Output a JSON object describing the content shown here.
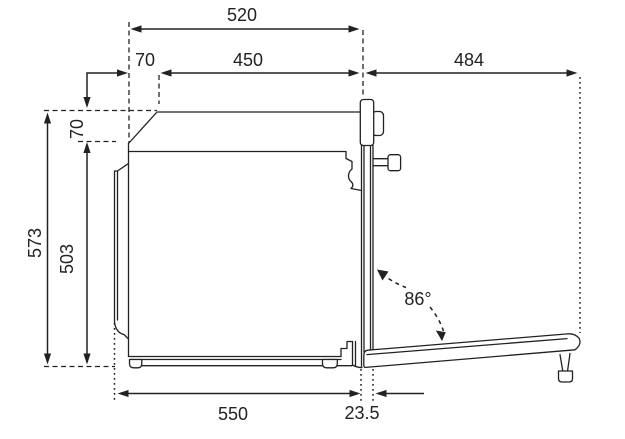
{
  "colors": {
    "ink": "#222222",
    "background": "#ffffff"
  },
  "diagram_subject": "built-in oven side profile, door open",
  "dimensions": {
    "top_overall": "520",
    "top_offset": "70",
    "top_inner": "450",
    "door_projection": "484",
    "height_overall": "573",
    "cavity_height": "503",
    "top_height_offset": "70",
    "bottom_depth": "550",
    "door_thickness": "23.5",
    "door_opening_angle": "86°"
  }
}
